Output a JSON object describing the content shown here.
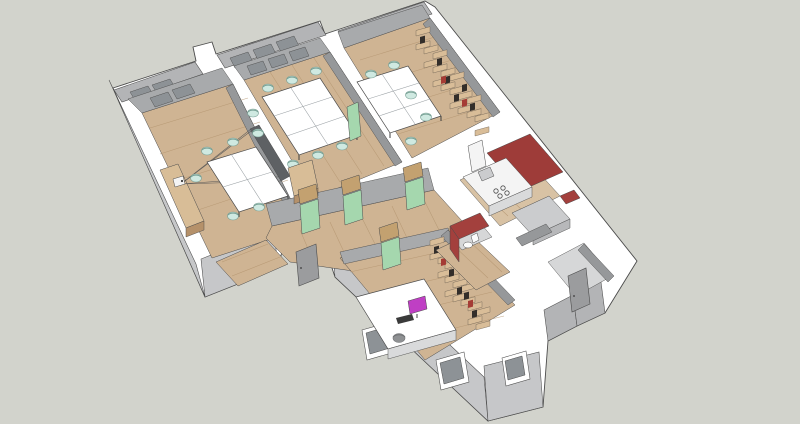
{
  "scene": {
    "type": "3d-cutaway-floor-plan",
    "style": "sketchup-like architectural model render",
    "view": "aerial isometric cutaway of an office apartment, walls sectioned white",
    "rooms": [
      {
        "id": "conference-room",
        "furniture": [
          "sideboard",
          "projector",
          "projection-screen-board",
          "white-table-4-panel",
          "6 mint chairs",
          "window"
        ]
      },
      {
        "id": "meeting-room",
        "furniture": [
          "white-table-6-panel",
          "7 mint chairs",
          "3 window panes"
        ]
      },
      {
        "id": "team-room",
        "furniture": [
          "white-table-6-panel",
          "5 mint chairs",
          "staggered-wood-bookshelf",
          "window"
        ]
      },
      {
        "id": "corridor",
        "furniture": [
          "wood-wardrobe",
          "3 green doors with wood transoms",
          "open-green-door-leaf"
        ]
      },
      {
        "id": "entry",
        "furniture": [
          "gray-entry-door"
        ]
      },
      {
        "id": "office",
        "furniture": [
          "white-desk",
          "magenta-monitor",
          "keyboard",
          "gray-task-chair",
          "staggered-wood-bookshelf",
          "green-door"
        ]
      },
      {
        "id": "kitchen",
        "furniture": [
          "red-accent-wall",
          "white-counter-with-4-burner-stove",
          "tall-cabinet",
          "gray-counter-run",
          "sink"
        ]
      },
      {
        "id": "bathroom",
        "furniture": [
          "red-walls",
          "toilet"
        ]
      },
      {
        "id": "utility-wing",
        "furniture": [
          "gray-door",
          "red-wall-sliver"
        ]
      }
    ],
    "window_openings_front": 3,
    "background": "plain light gray"
  },
  "palette": {
    "background": "#d2d3cc",
    "line": "#4b4b4b",
    "wall_top": "#ffffff",
    "facade": "#c6c7c9",
    "facade_shaded": "#b3b4b6",
    "wall_inner": "#a8aaac",
    "wall_inner_dark": "#96989a",
    "glass": "#8d9296",
    "floor": "#cfb493",
    "floor_light": "#d8c2a4",
    "wing_floor": "#d6d7d8",
    "plank": "#b3946f",
    "table": "#ffffff",
    "table_edge": "#9aa0a4",
    "chair": "#cfe9e1",
    "chair_rim": "#79a196",
    "door": "#a5d7ae",
    "door_frame_wood": "#c3a170",
    "door_gray": "#9b9c9e",
    "wood_furniture": "#d8bd97",
    "wood_furniture_dark": "#b5916a",
    "shelf_wood": "#d9bd98",
    "shelf_book_dark": "#332e2a",
    "shelf_book_red": "#a53c35",
    "kitchen_red": "#9e3c39",
    "bathroom_red": "#a3403d",
    "counter": "#f4f4f4",
    "counter_side": "#d9dadb",
    "cabinet": "#cbccce",
    "cabinet_side": "#b7b8ba",
    "screen_board": "#5e6164",
    "projector_line": "#555555",
    "monitor": "#bf3fc4",
    "office_chair": "#8f9193",
    "toilet": "#fbfbfb"
  }
}
